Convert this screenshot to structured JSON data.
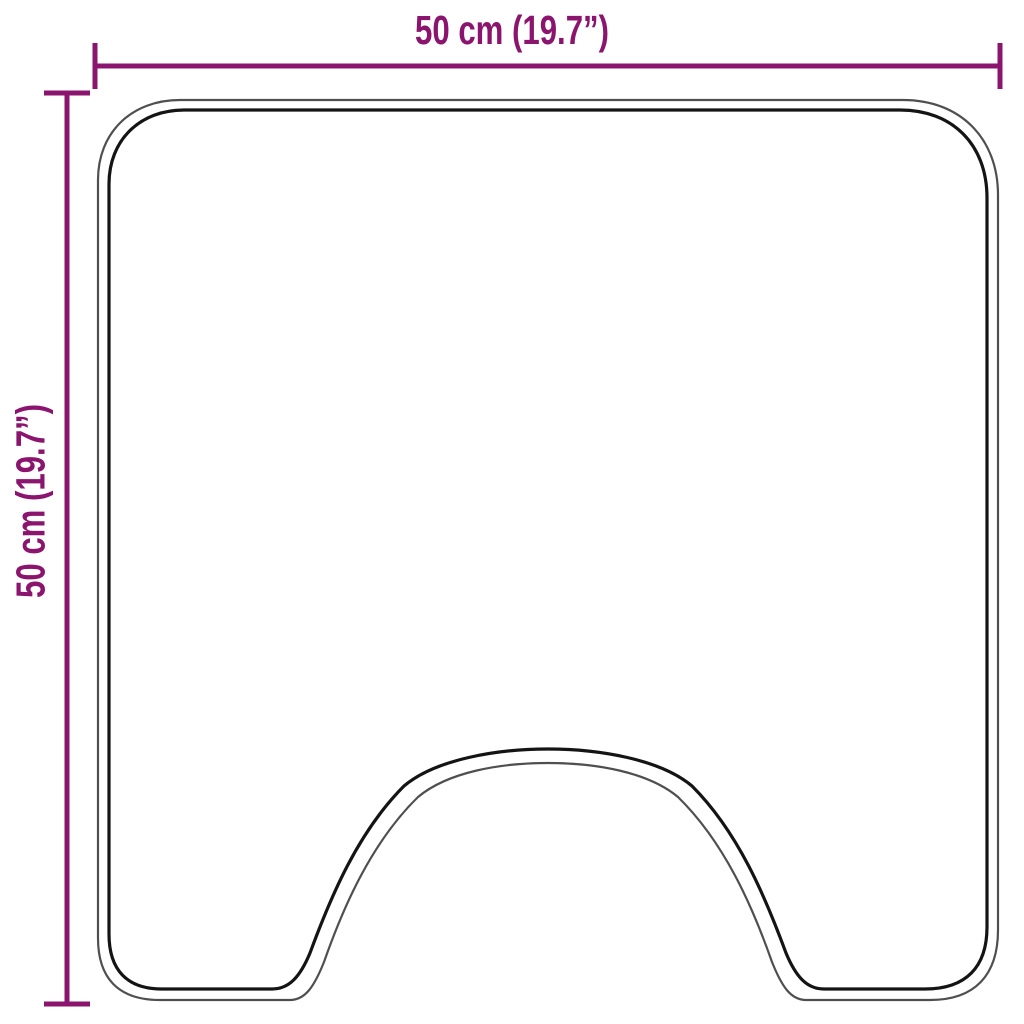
{
  "diagram": {
    "title": "product-dimension-diagram",
    "width": {
      "cm": 50,
      "inches": 19.7,
      "label": "50 cm (19.7”)"
    },
    "height": {
      "cm": 50,
      "inches": 19.7,
      "label": "50 cm (19.7”)"
    }
  },
  "colors": {
    "dimension": "#8B146E",
    "outline_outer": "#4f4f4f",
    "outline_inner": "#141414",
    "background": "#ffffff"
  }
}
